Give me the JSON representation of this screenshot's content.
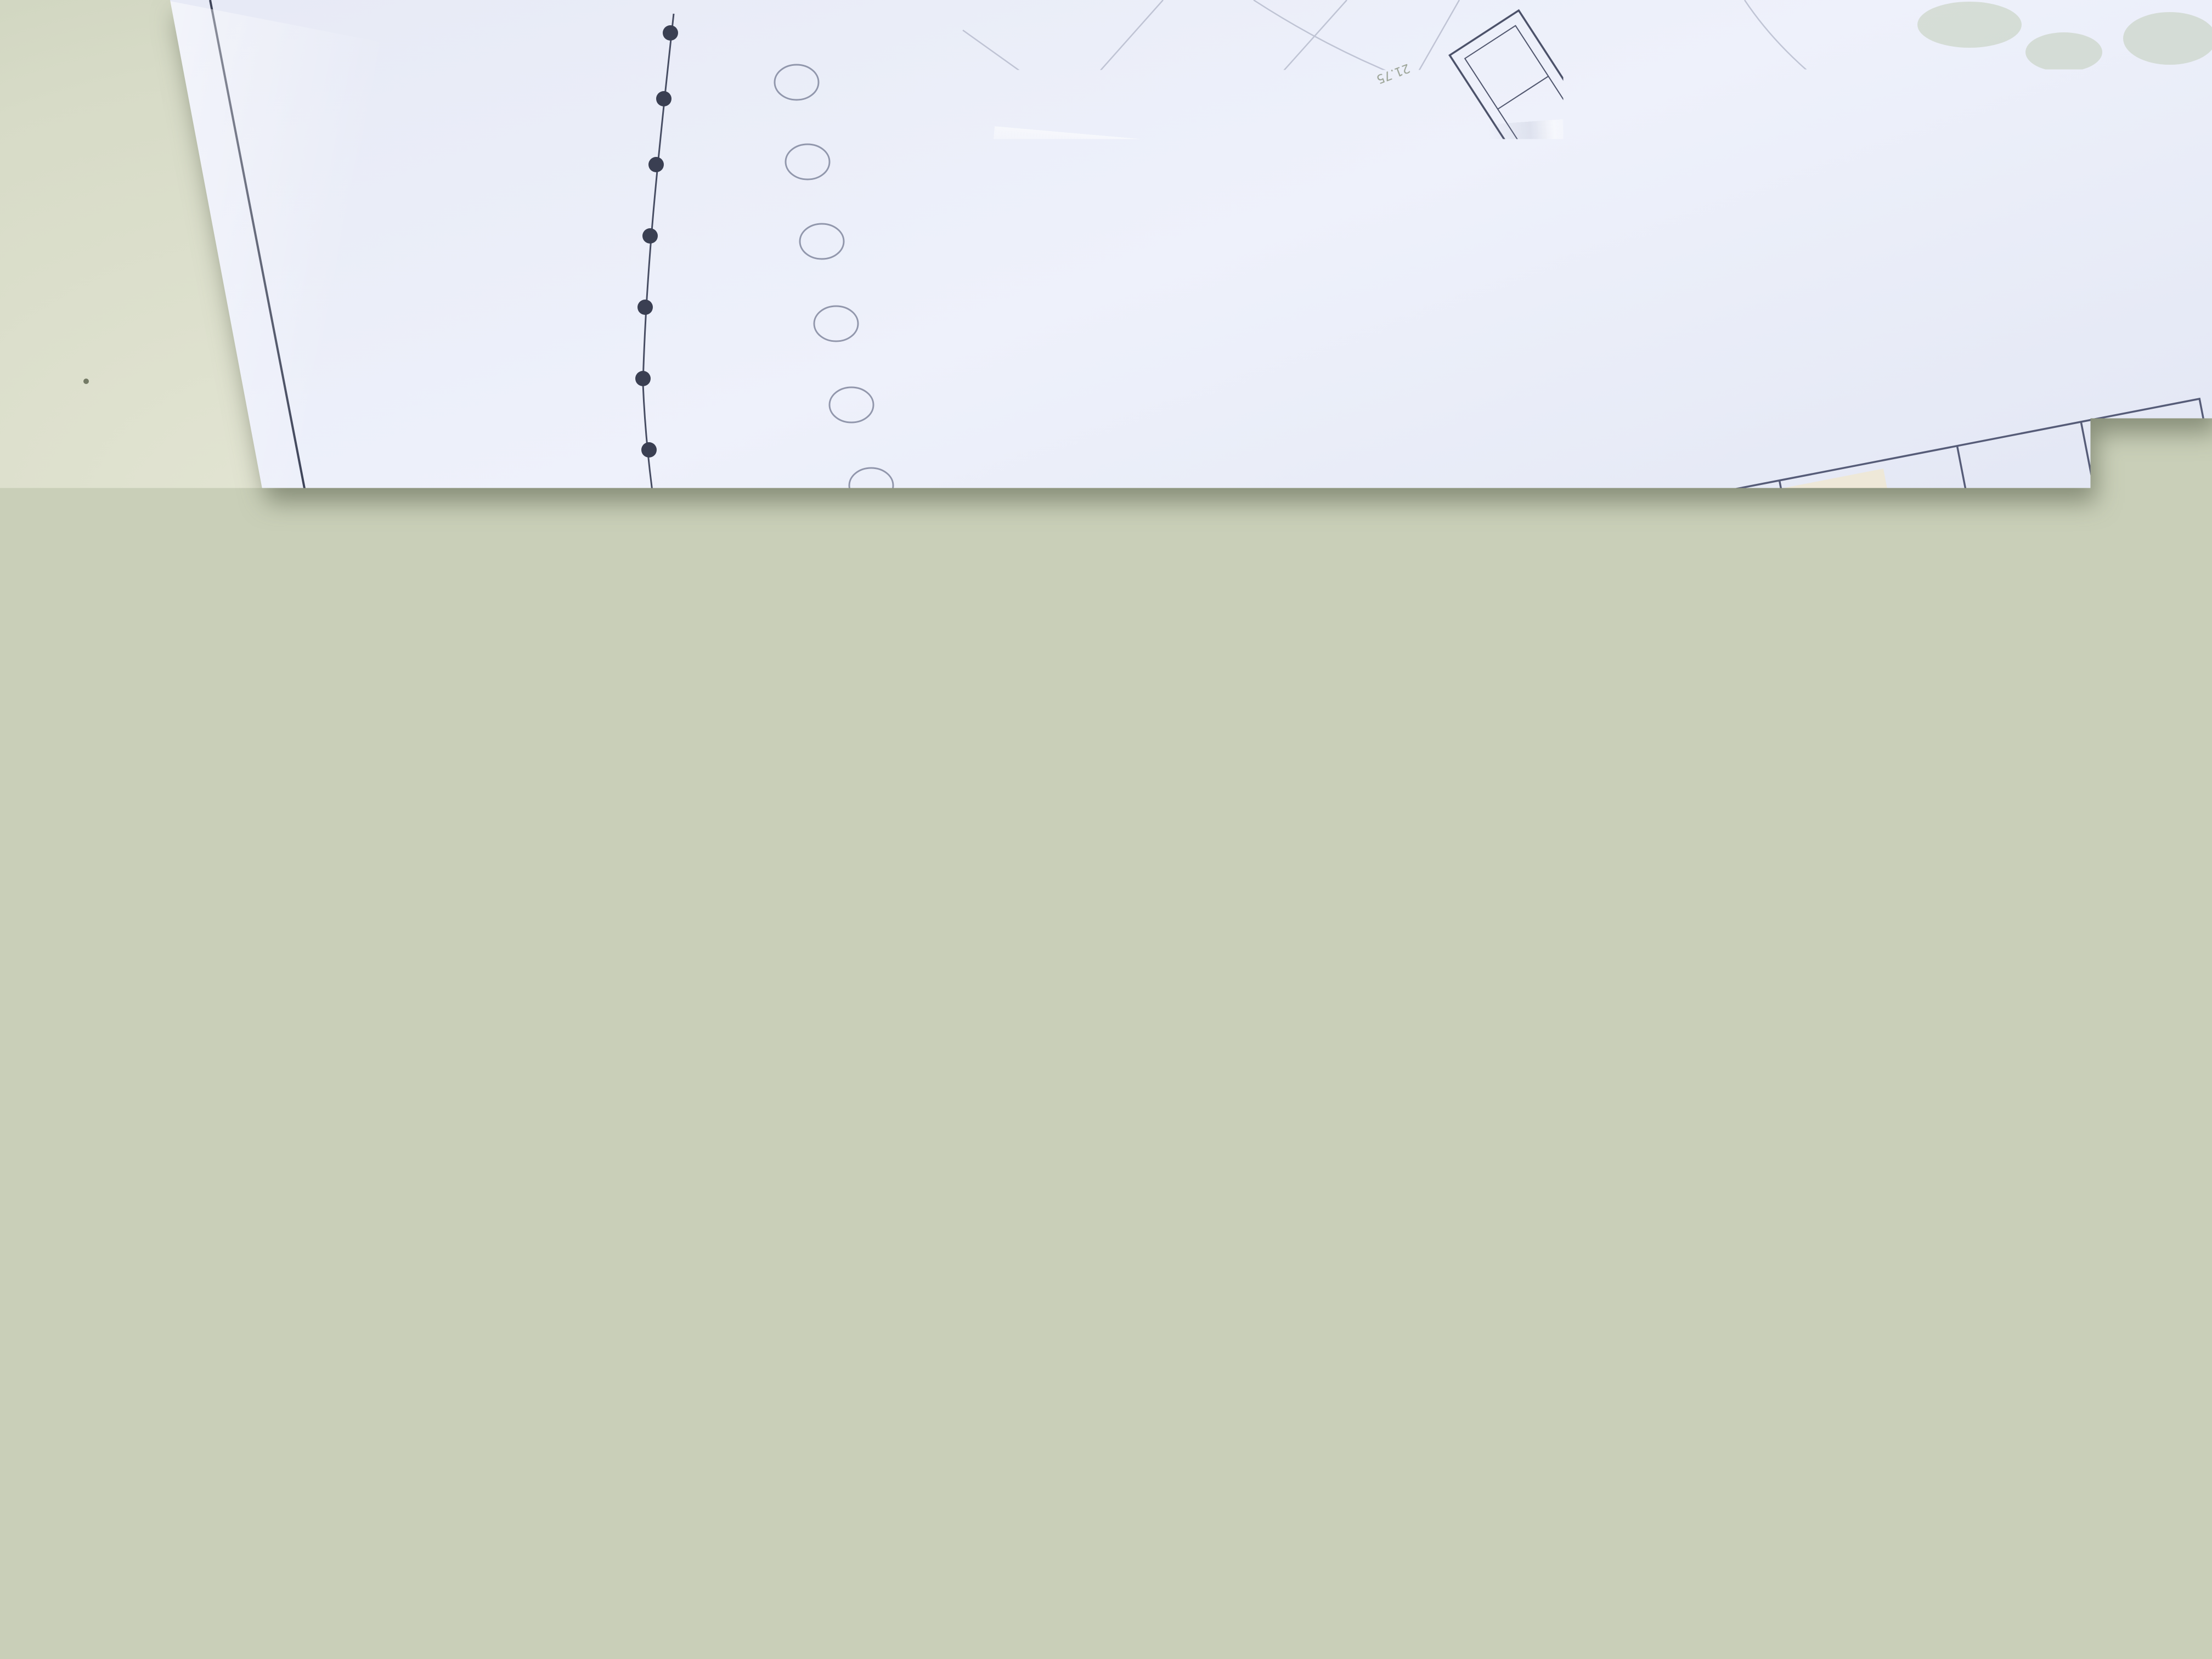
{
  "photo": {
    "sheet_number": "3",
    "fence_label": "clôture"
  },
  "title_block": {
    "department": "DEPARTEMENT DE CORSE DU SUD",
    "commune": "COMMUNE DE SARTE",
    "main_title_lines": [
      "MISE EN CONFORMITE DE LA",
      "STATION DE TRAITEMENT",
      "D'EAU POTABLE DE SARTE"
    ],
    "subtitle": "STATION ET ABORDS IMMEDIATS",
    "subtitle2": "Vue en plan et coupes - Projet",
    "modifications": {
      "label": "Modifications:",
      "columns": [
        "Ind.",
        "Date",
        "Nom",
        "Désignation"
      ],
      "rows": [
        {
          "ind": "D",
          "date": "",
          "nom": "",
          "designation": ""
        },
        {
          "ind": "C",
          "date": "",
          "nom": "",
          "designation": ""
        },
        {
          "ind": "B",
          "date": "",
          "nom": "",
          "designation": ""
        },
        {
          "ind": "A",
          "date": "18/09/2017",
          "nom": "F. Pietrotti",
          "designation": "Création du document"
        }
      ]
    },
    "info": {
      "echelle_label": "Echelle",
      "echelle_value": "1:100",
      "format_label": "Format",
      "format_value": "A0",
      "ingenieur_label": "Ingénieur",
      "ingenieur_value": "M-L Casabianca",
      "dao_label": "DAO/CAO",
      "dao_value": "F. Pietrotti",
      "numero_label": "Numéro du plan",
      "numero_value": "SAR-STP-PF-09-17-1012-3",
      "revision": "A"
    },
    "footer": {
      "org_name": "Office d'Equipement Hydraulique de Corse",
      "address": "Avenue Paul GIACOBBI  -  B.P.678  -  20601 BASTIA",
      "phone": "Tél 04.95.30.93.93  -  Télécopie 04.95.30.50.29",
      "logo_lines": [
        "CULLETTIVITÀ di CORSICA",
        "COLLECTIVITÉ de CORSE"
      ],
      "logo_sub_lines": [
        "Uffiziu d'Equipamentu",
        "Idraulicu di Corsica",
        "Office d'Equipement",
        "Hydraulique de Corse"
      ]
    }
  },
  "plan_annotations": {
    "elevations": [
      "21.75",
      "21.86",
      "21.63",
      "21.66",
      "21.39",
      "21.71"
    ]
  },
  "colors": {
    "paper": "#e9ecf7",
    "table": "#ccd3ba",
    "ink": "#3e4459",
    "brand_blue": "#35508f",
    "pipe_salmon": "#e2a093",
    "annotation_red": "#c0504d",
    "vegetation_green": "#b9c6ab"
  }
}
